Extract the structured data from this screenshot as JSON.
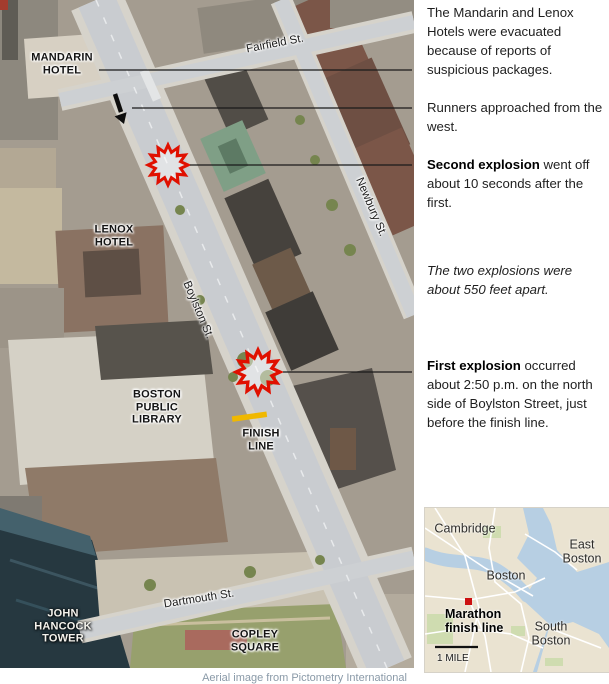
{
  "map": {
    "labels": {
      "mandarin": "MANDARIN\nHOTEL",
      "lenox": "LENOX\nHOTEL",
      "library": "BOSTON\nPUBLIC\nLIBRARY",
      "finish": "FINISH\nLINE",
      "hancock": "JOHN\nHANCOCK\nTOWER",
      "copley": "COPLEY\nSQUARE"
    },
    "streets": {
      "fairfield": "Fairfield St.",
      "newbury": "Newbury St.",
      "boylston": "Boylston St.",
      "dartmouth": "Dartmouth St."
    },
    "colors": {
      "explosion_red": "#e01000",
      "finish_line_yellow": "#f0b800"
    }
  },
  "annotations": {
    "evacuation": "The Mandarin and Lenox Hotels were evacuated because of reports of suspicious packages.",
    "runners": "Runners approached from the west.",
    "second_lead": "Second explosion",
    "second_rest": " went off about 10 seconds after the first.",
    "distance_note": "The two explosions were about 550 feet apart.",
    "first_lead": "First explosion",
    "first_rest": " occurred about 2:50 p.m. on the north side of Boylston Street, just before the finish line."
  },
  "inset": {
    "labels": {
      "cambridge": "Cambridge",
      "east_boston": "East\nBoston",
      "boston": "Boston",
      "south_boston": "South\nBoston",
      "marathon": "Marathon\nfinish line",
      "scale": "1 MILE"
    },
    "colors": {
      "water": "#b7cfe3",
      "land": "#eae3d1",
      "marker_red": "#cc1111"
    }
  },
  "caption": "Aerial image from Pictometry International"
}
